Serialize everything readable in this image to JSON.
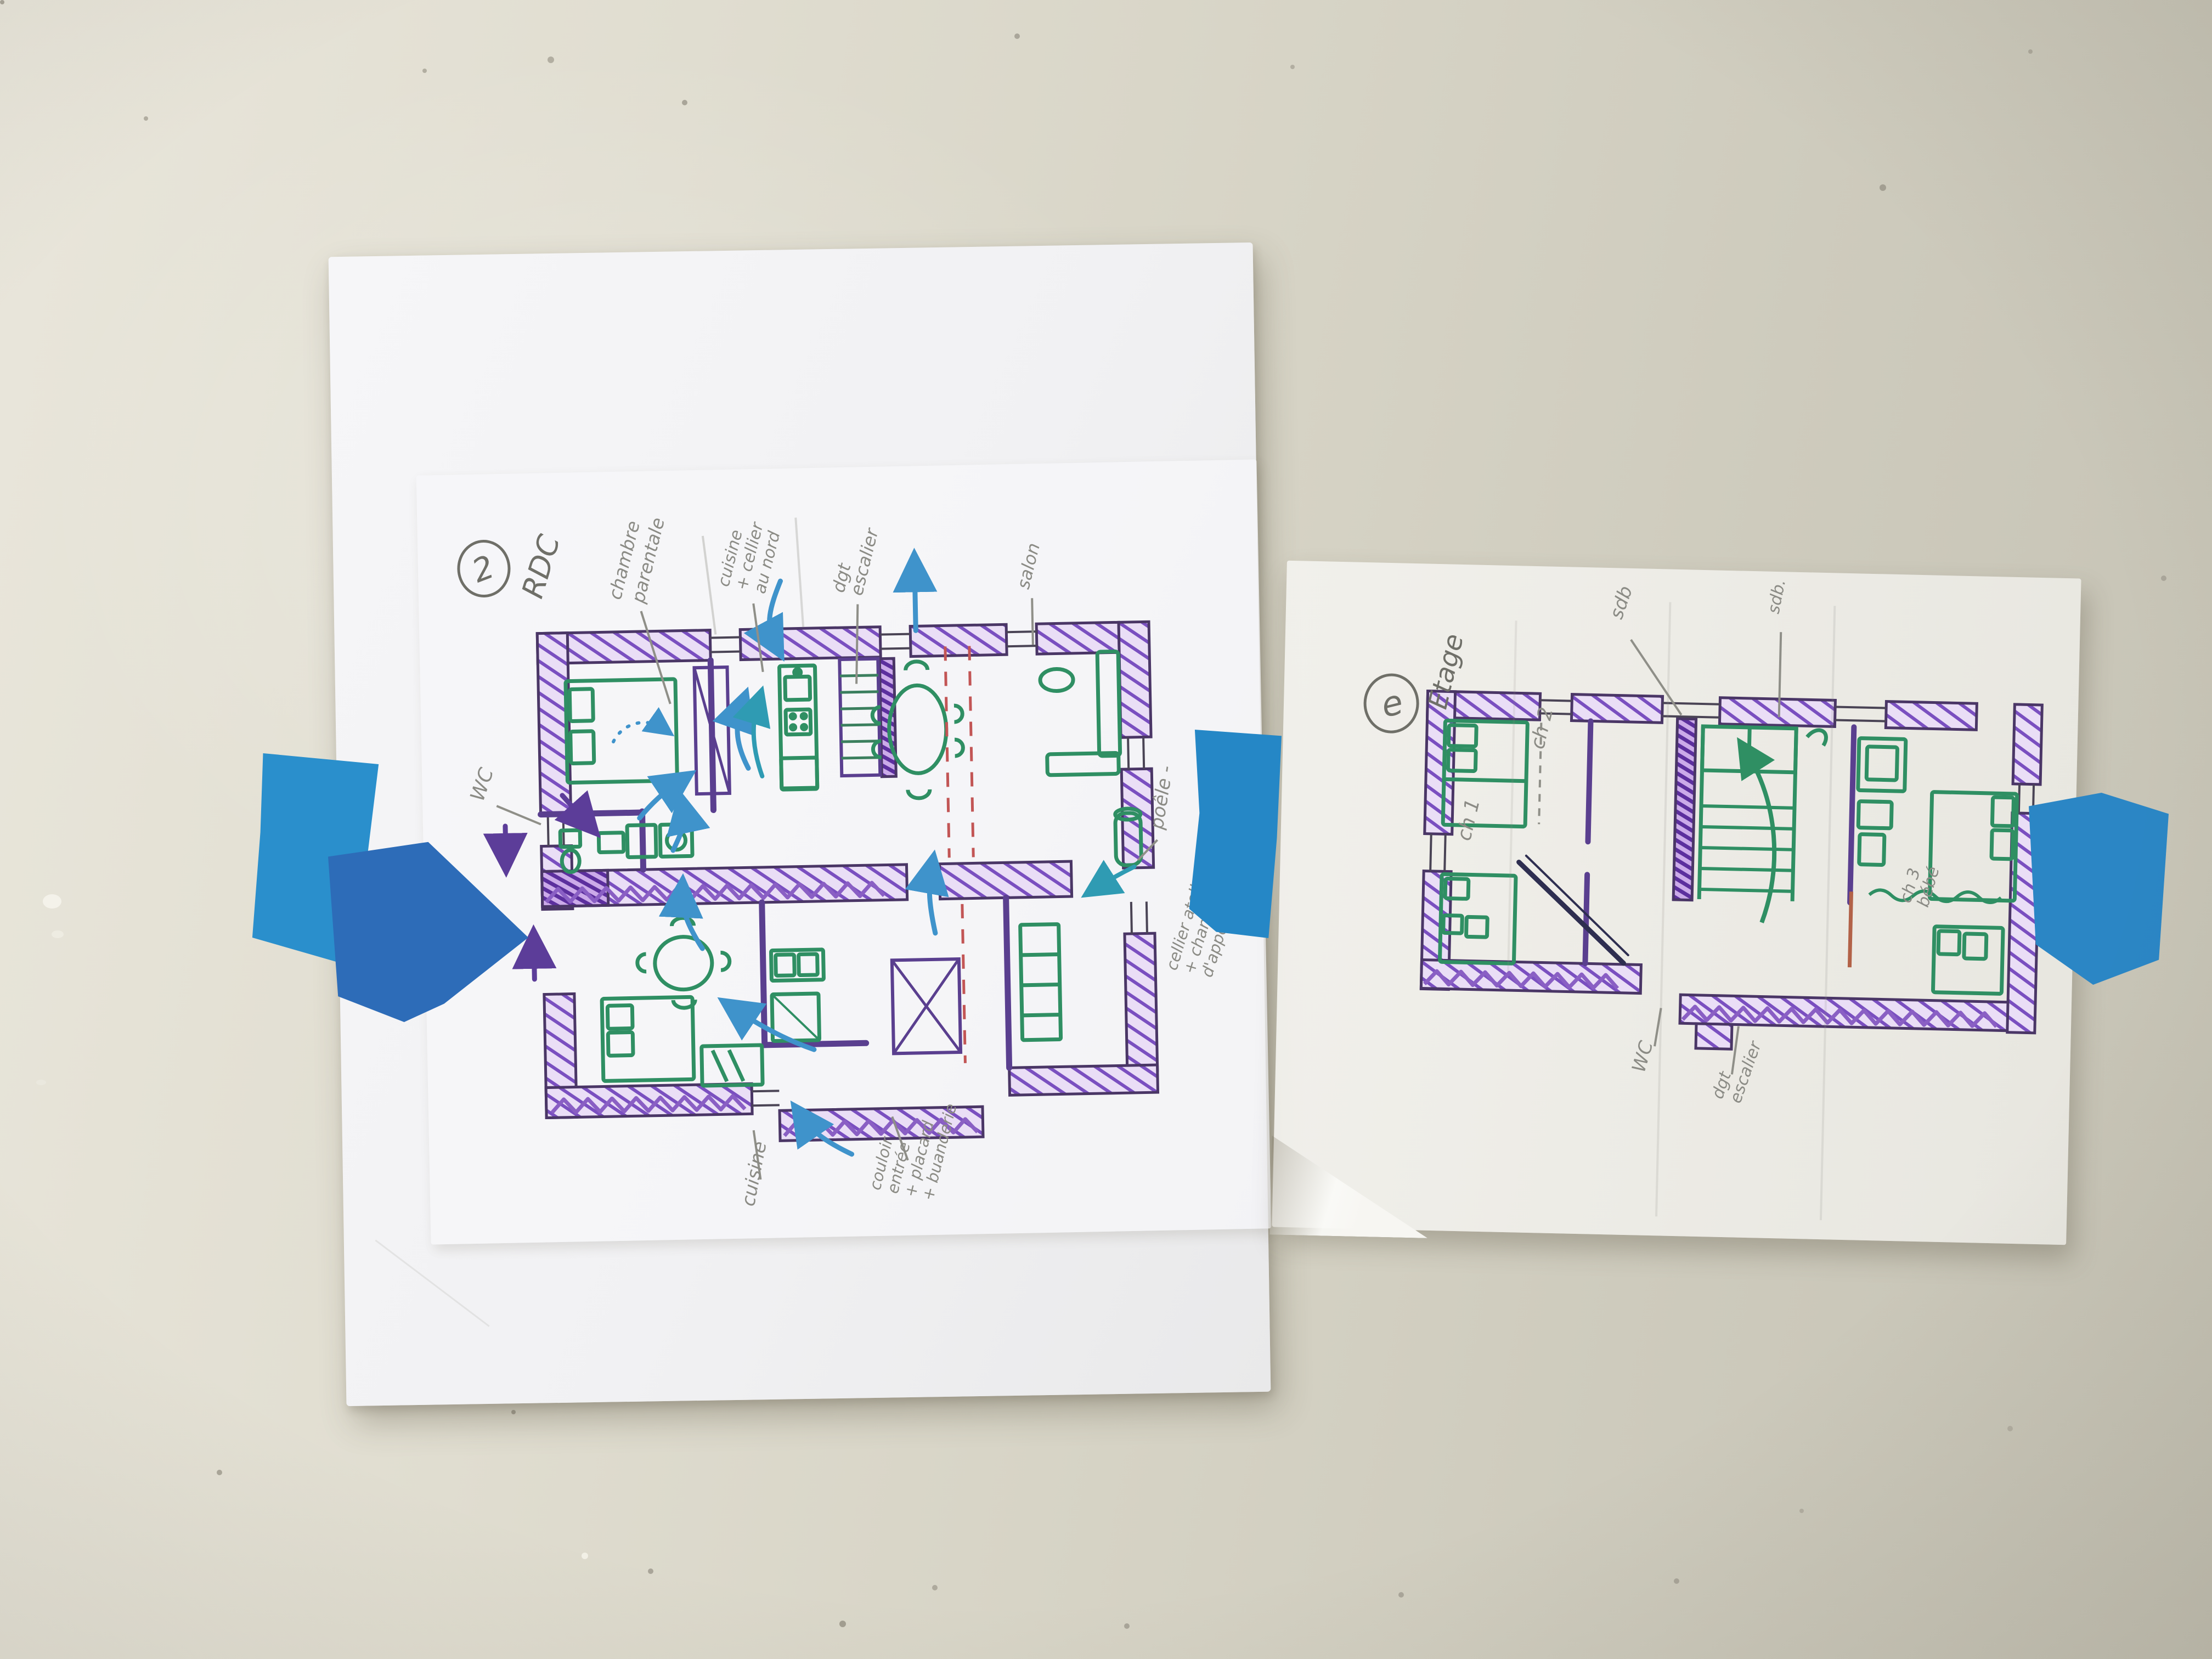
{
  "scene": {
    "description": "Photo of two hand-drawn floor plan sketches on tracing paper taped to a beige wall with blue painter's tape",
    "wall_color": "#d7d4c6",
    "paper_color": "#f3f3f5",
    "tape_color_light": "#2a8fcc",
    "tape_color_dark": "#2d6cb8",
    "ink_colors": {
      "walls_hatch": "#7a4fc0",
      "wall_outline": "#4a3666",
      "furniture": "#2f8f63",
      "flow_arrows": "#3f93cb",
      "secondary_arrows": "#2f9bb3",
      "entry_arrows": "#5c3d99",
      "axis_dashed": "#c25555",
      "pencil": "#8b8b85"
    }
  },
  "sheets": [
    {
      "id": "rdc",
      "title_number": "2",
      "title_label": "RDC",
      "labels": [
        {
          "name": "chambre-parentale",
          "lines": [
            "chambre",
            "parentale"
          ]
        },
        {
          "name": "cuisine-cellier-nord",
          "lines": [
            "cuisine",
            "+ cellier",
            "au nord"
          ]
        },
        {
          "name": "dgt-escalier",
          "lines": [
            "dgt",
            "escalier"
          ]
        },
        {
          "name": "salon",
          "lines": [
            "salon"
          ]
        },
        {
          "name": "wc",
          "lines": [
            "WC"
          ]
        },
        {
          "name": "poele",
          "lines": [
            "poêle -"
          ]
        },
        {
          "name": "cellier-atelier",
          "lines": [
            "cellier atelier",
            "+ chambre",
            "d'appoint"
          ]
        },
        {
          "name": "cuisine",
          "lines": [
            "cuisine"
          ]
        },
        {
          "name": "couloir-entree",
          "lines": [
            "couloir",
            "entrée",
            "+ placard",
            "+ buanderie"
          ]
        }
      ]
    },
    {
      "id": "etage",
      "title_number": "e",
      "title_label": "Etage",
      "labels": [
        {
          "name": "sdb",
          "lines": [
            "sdb"
          ]
        },
        {
          "name": "sdb-2",
          "lines": [
            "sdb."
          ]
        },
        {
          "name": "ch2",
          "lines": [
            "ch 2"
          ]
        },
        {
          "name": "ch1",
          "lines": [
            "ch 1"
          ]
        },
        {
          "name": "ch3-bebe",
          "lines": [
            "ch 3",
            "bébé"
          ]
        },
        {
          "name": "wc",
          "lines": [
            "WC"
          ]
        },
        {
          "name": "dgt-escalier",
          "lines": [
            "dgt",
            "escalier"
          ]
        }
      ]
    }
  ]
}
